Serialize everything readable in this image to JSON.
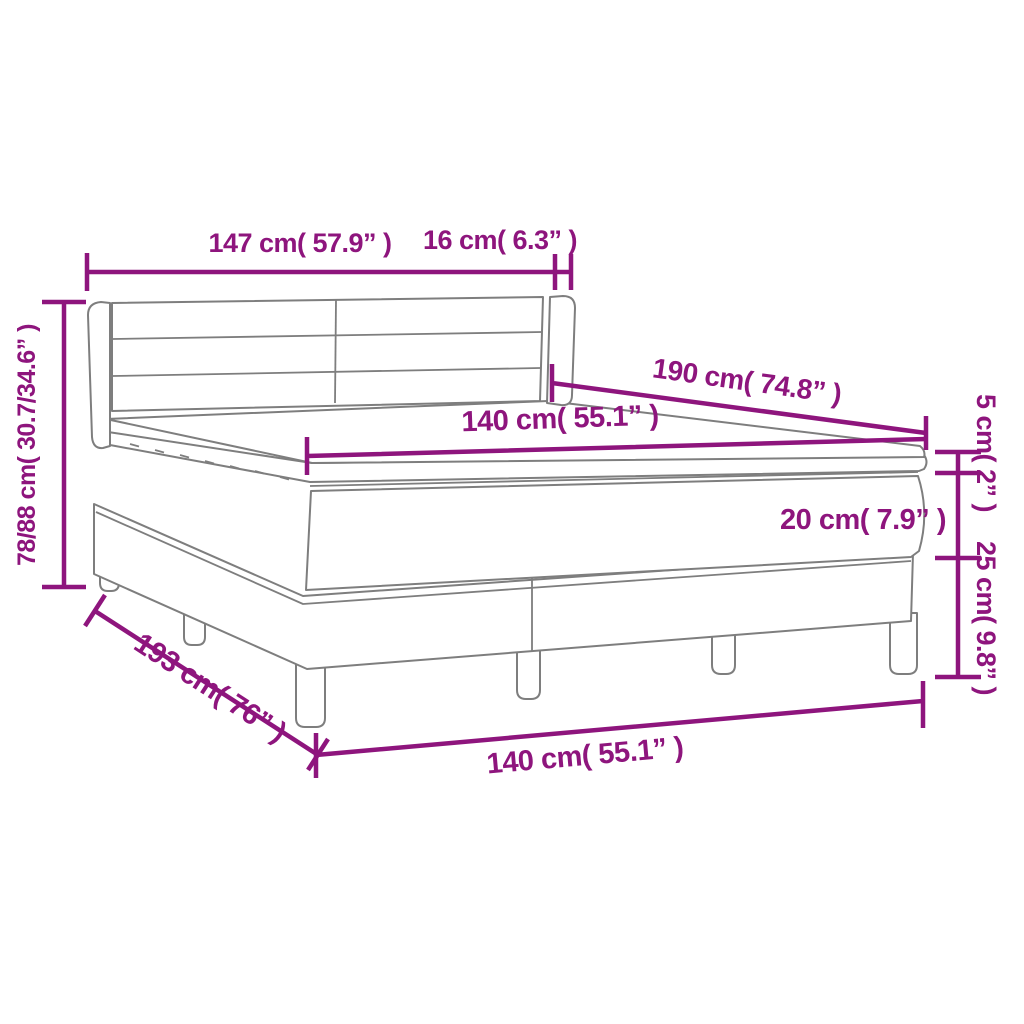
{
  "title": "Box spring bed with mattress — dimension diagram",
  "colors": {
    "dimension_color": "#8E157D",
    "outline_color": "#7E7E7E",
    "background": "#FFFFFF"
  },
  "dimensions": {
    "headboard_width": "147 cm( 57.9” )",
    "headboard_depth": "16 cm( 6.3” )",
    "overall_height": "78/88 cm( 30.7/34.6” )",
    "mattress_length": "190 cm( 74.8” )",
    "mattress_width": "140 cm( 55.1” )",
    "topper_height": "5 cm( 2” )",
    "mattress_height": "20 cm( 7.9” )",
    "base_height": "25 cm( 9.8” )",
    "frame_length": "193 cm( 76” )",
    "frame_width": "140 cm( 55.1” )"
  }
}
